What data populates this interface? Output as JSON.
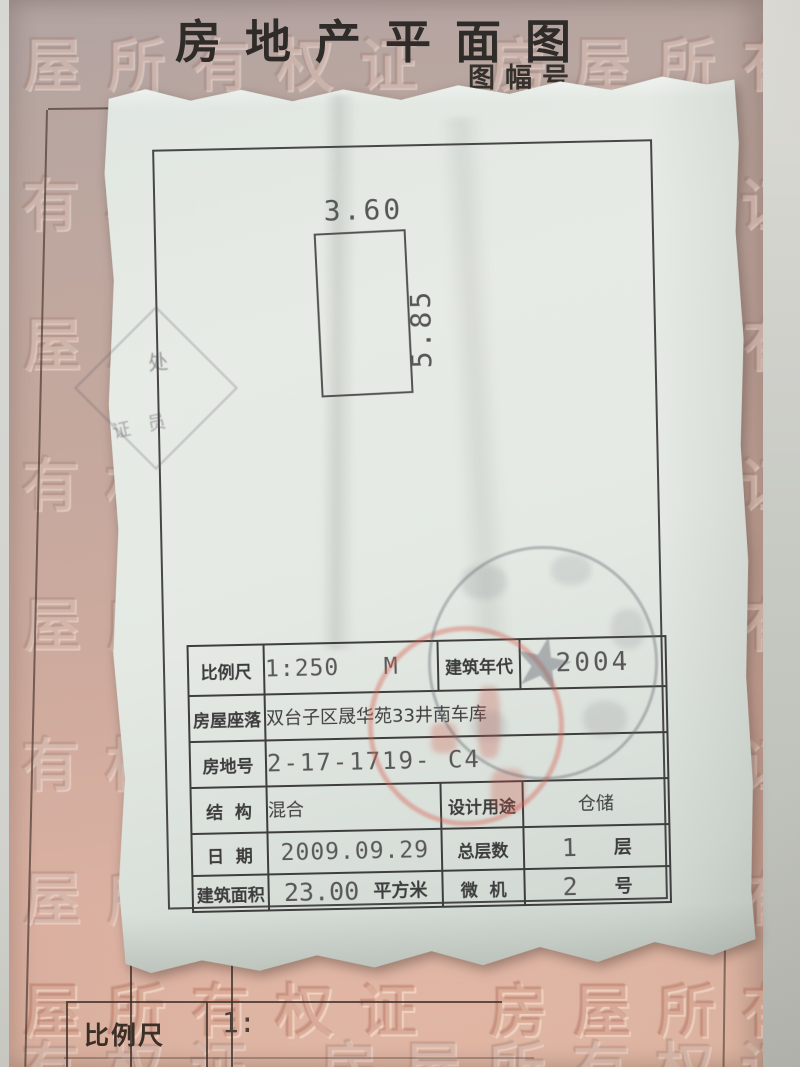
{
  "page": {
    "title": "房地产平面图",
    "subtitle": "图幅号",
    "watermark_text": "房屋所有权证 房屋所有权证",
    "bottom_form": {
      "scale_label": "比例尺",
      "scale_value": "1:"
    }
  },
  "plan": {
    "width": "3.60",
    "depth": "5.85"
  },
  "info_table": {
    "rows": [
      {
        "label": "比例尺",
        "value": "1:250   M",
        "label2": "建筑年代",
        "value2": "2004"
      },
      {
        "label": "房屋座落",
        "value": "双台子区晟华苑33井南车库"
      },
      {
        "label": "房地号",
        "value": "2-17-1719- C4"
      },
      {
        "label": "结  构",
        "value": "混合",
        "label2": "设计用途",
        "value2": "仓储"
      },
      {
        "label": "日  期",
        "value": "2009.09.29",
        "label2": "总层数",
        "value2": "1",
        "unit2": "层"
      },
      {
        "label": "建筑面积",
        "value": "23.00",
        "unit": "平方米",
        "label2": "微  机",
        "value2": "2",
        "unit2": "号"
      }
    ]
  },
  "stamps": {
    "round_seal_star": "★",
    "corner_seal_fragments": [
      "处",
      "证 员"
    ]
  },
  "colors": {
    "stamp_red": "#d96a58",
    "page_pink": "#c9a89d",
    "paper": "#e3e8e2",
    "ink": "#3e3e3e"
  }
}
